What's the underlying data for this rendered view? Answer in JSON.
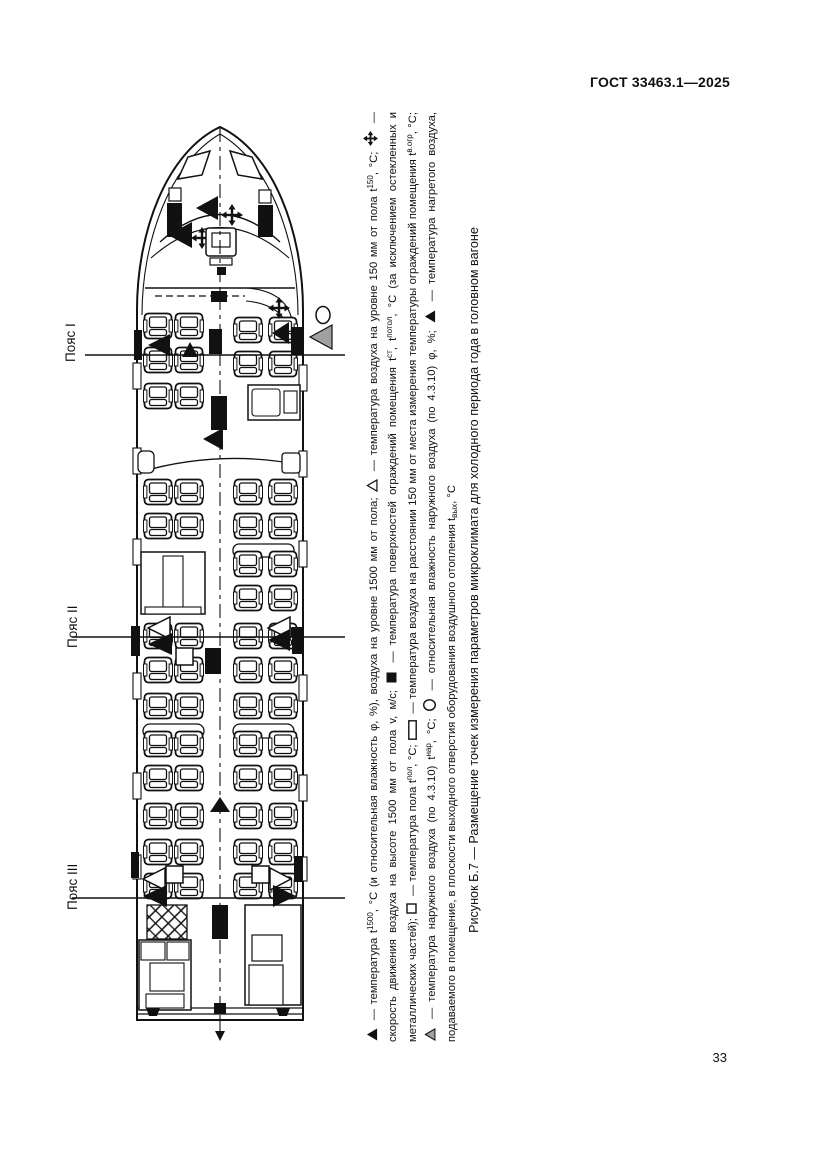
{
  "page": {
    "header": "ГОСТ 33463.1—2025",
    "page_number": "33"
  },
  "figure": {
    "caption": "Рисунок Б.7 — Размещение точек измерения параметров микроклимата для холодного периода года в головном вагоне",
    "zones": [
      {
        "label": "Пояс I"
      },
      {
        "label": "Пояс II"
      },
      {
        "label": "Пояс III"
      }
    ],
    "legend": [
      {
        "symbol": "triangle-filled-icon",
        "text": "— температура t^{1500}, °C (и относительная влажность φ, %), воздуха на уровне 1500 мм от пола;"
      },
      {
        "symbol": "triangle-open-icon",
        "text": "— температура воздуха на уровне 150 мм от пола t^{150}, °C;"
      },
      {
        "symbol": "arrows-cross-icon",
        "text": "— скорость движения воздуха на высоте 1500 мм от пола v, м/с;"
      },
      {
        "symbol": "square-filled-icon",
        "text": "— температура поверхностей ограждений помещения t^{ст}, t^{потол}, °C (за исключением остекленных и металлических частей);"
      },
      {
        "symbol": "square-open-icon",
        "text": "— температура пола t^{пол}, °C;"
      },
      {
        "symbol": "rect-open-icon",
        "text": "— температура воздуха на расстоянии 150 мм от места измерения температуры ограждений помещения t^{в.огр}, °C;"
      },
      {
        "symbol": "triangle-gray-icon",
        "text": "— температура наружного воздуха (по 4.3.10) t^{нар}, °C;"
      },
      {
        "symbol": "circle-open-icon",
        "text": "— относительная влажность наружного воздуха (по 4.3.10) φ, %;"
      },
      {
        "symbol": "triangle-filled-icon",
        "text": "— температура нагретого воздуха, подаваемого в помещение, в плоскости выходного отверстия оборудования воздушного отопления t_{вых}, °C"
      }
    ],
    "colors": {
      "ink": "#111111",
      "gray_triangle": "#a0a0a0"
    }
  }
}
